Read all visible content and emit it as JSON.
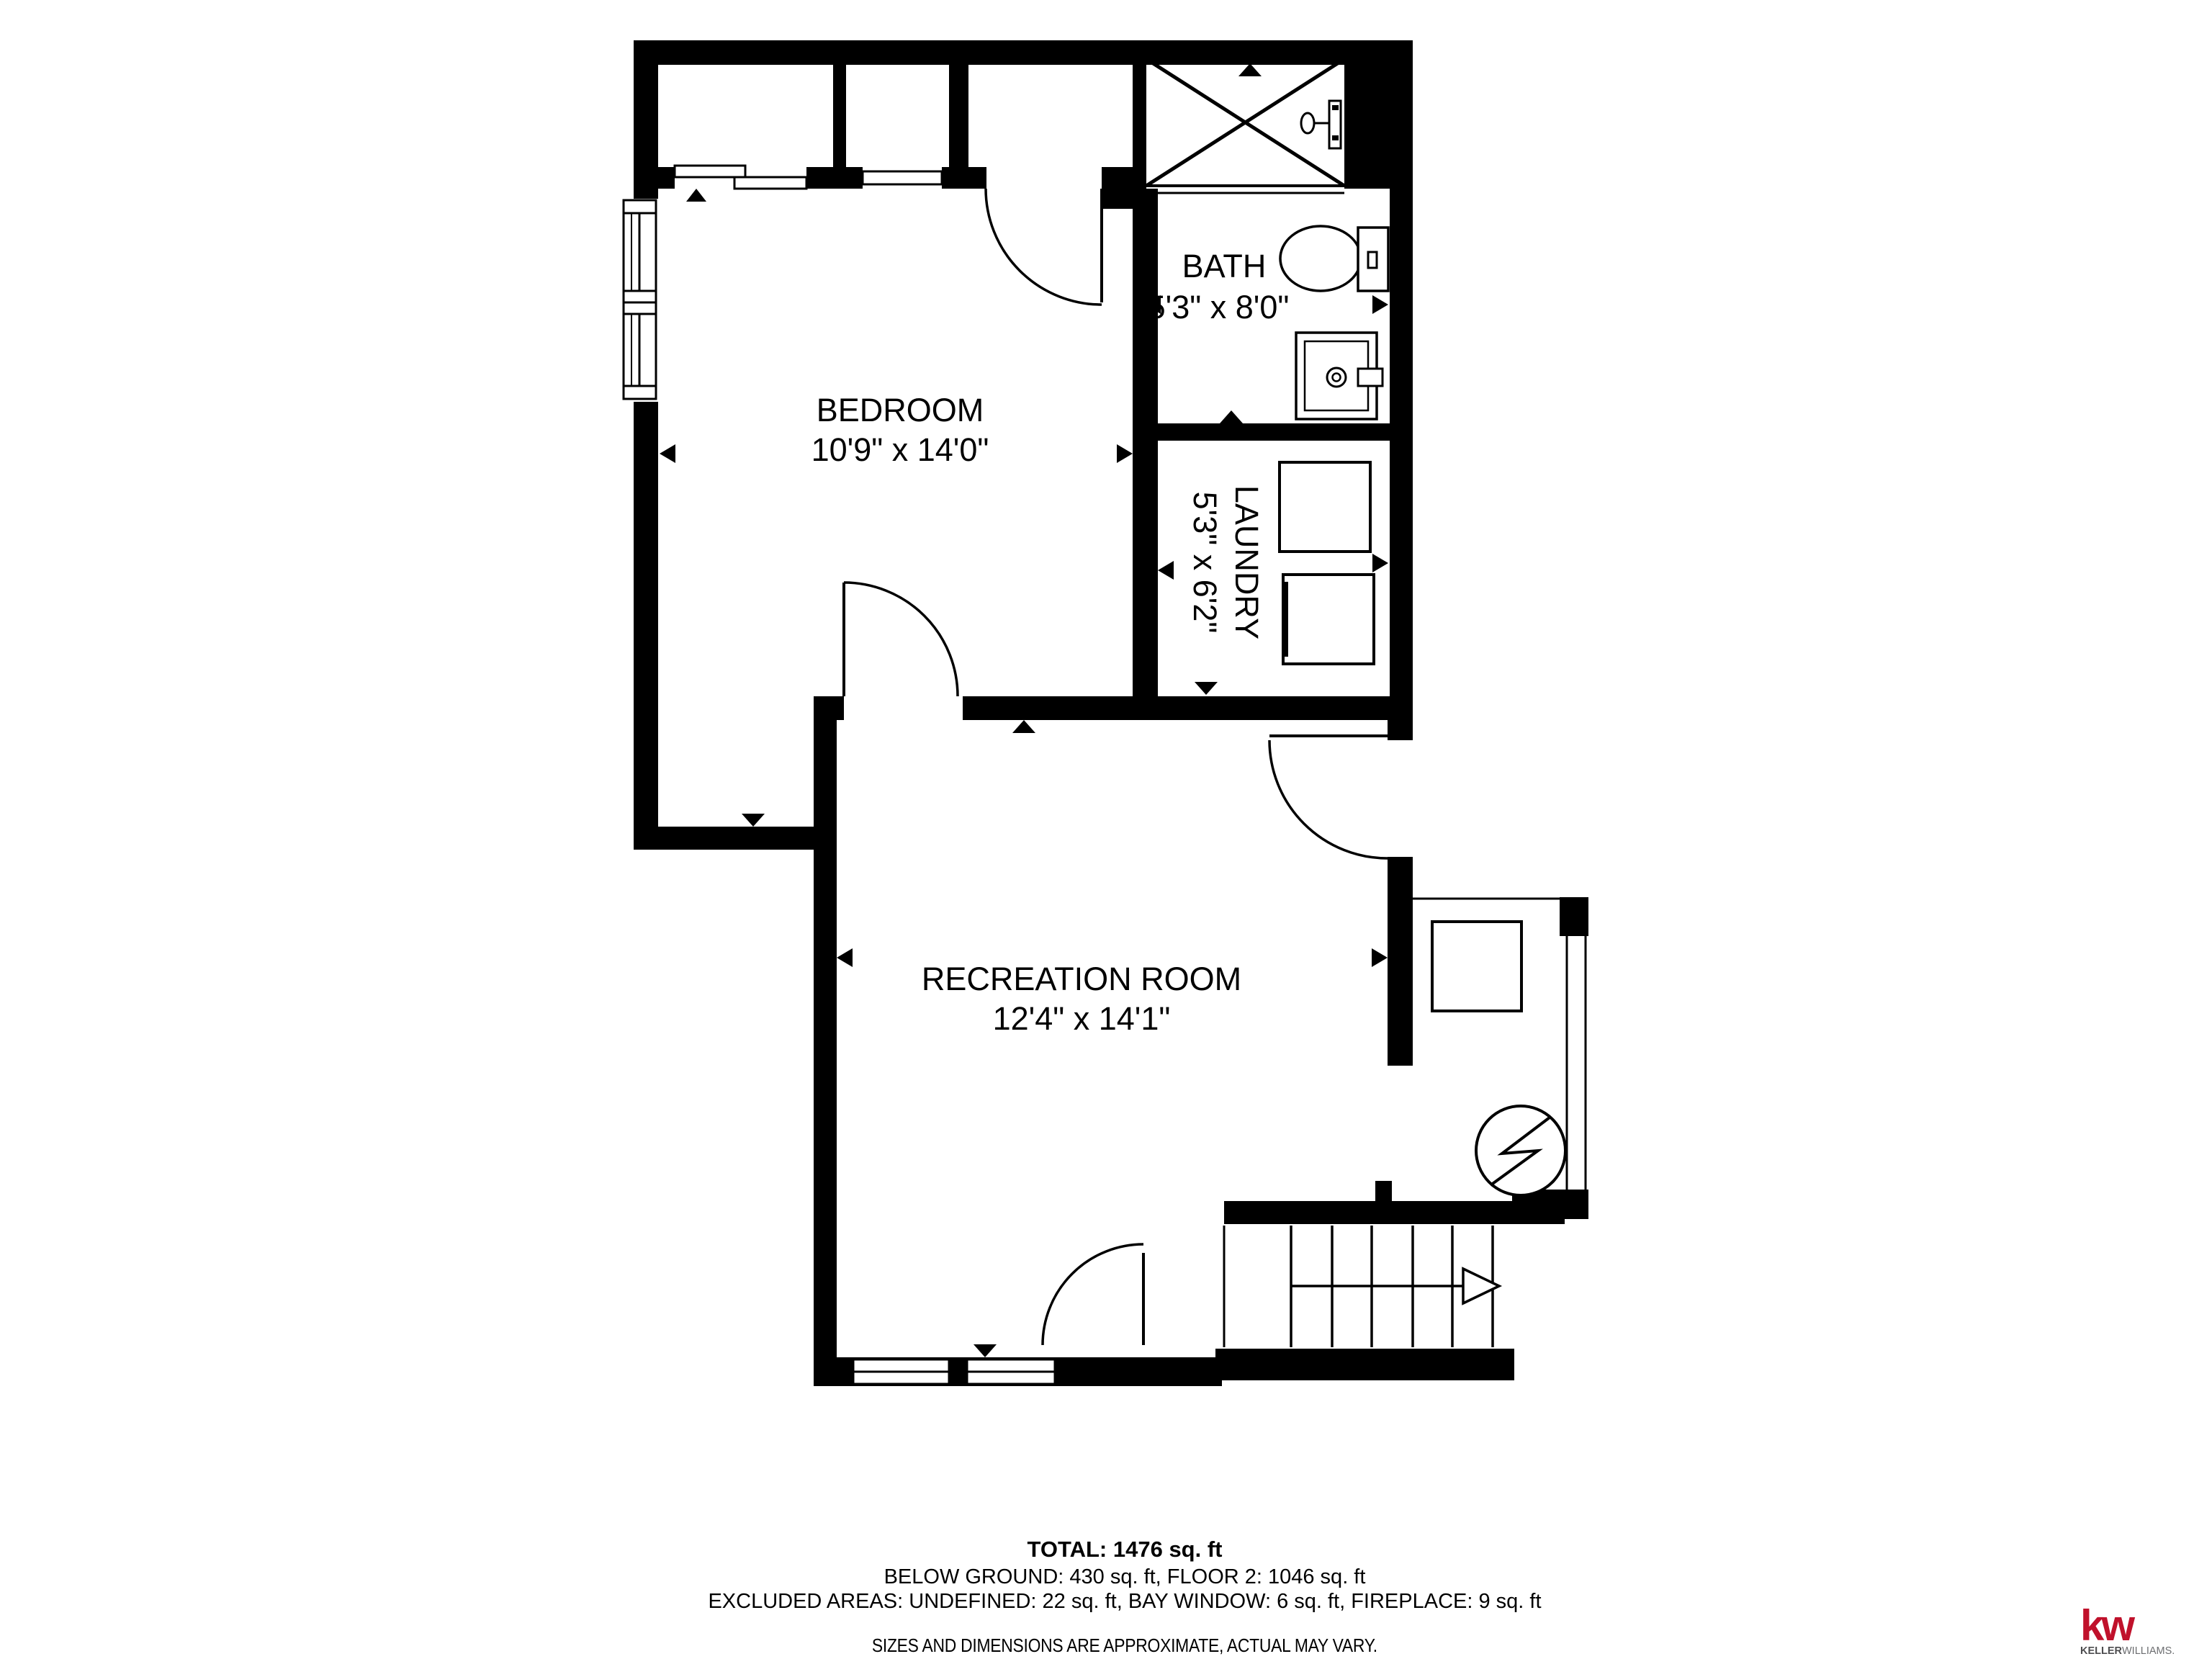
{
  "rooms": {
    "bedroom": {
      "name": "BEDROOM",
      "dims": "10'9\" x 14'0\""
    },
    "bath": {
      "name": "BATH",
      "dims": "5'3\" x 8'0\""
    },
    "laundry": {
      "name": "LAUNDRY",
      "dims": "5'3\" x 6'2\""
    },
    "recreation": {
      "name": "RECREATION ROOM",
      "dims": "12'4\" x 14'1\""
    }
  },
  "summary": {
    "total": "TOTAL: 1476 sq. ft",
    "floors": "BELOW GROUND: 430 sq. ft, FLOOR 2: 1046 sq. ft",
    "excluded": "EXCLUDED AREAS: UNDEFINED: 22 sq. ft, BAY WINDOW: 6 sq. ft, FIREPLACE: 9 sq. ft",
    "disclaimer": "SIZES AND DIMENSIONS ARE APPROXIMATE, ACTUAL MAY VARY."
  },
  "logo": {
    "mark": "kw",
    "brand_bold": "KELLER",
    "brand_light": "WILLIAMS.",
    "colors": {
      "red": "#c0112b",
      "gray": "#4d4d4f"
    }
  },
  "colors": {
    "walls": "#000000",
    "background": "#ffffff"
  }
}
